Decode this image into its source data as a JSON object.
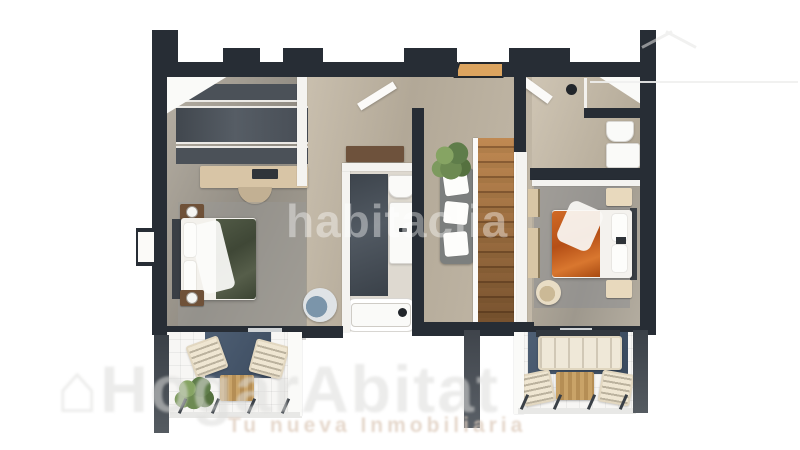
{
  "meta": {
    "description": "3D rendered top-down floor plan of an apartment upper floor: two bedrooms, two bathrooms, wooden staircase, hallway and two furnished terraces"
  },
  "watermarks": {
    "center": "habitaclia",
    "brand_house_icon": "⌂",
    "brand": "HogarAbitat",
    "tagline": "Tu nueva Inmobiliaria"
  },
  "colors": {
    "wall-dark": "#272d35",
    "floor-beige": "#c6bcab",
    "floor-gray": "#a9a49b",
    "white-surface": "#f4f3f0",
    "wood-stairs": "#a87544",
    "wood-light": "#dca45f",
    "closet-dark": "#4b5158",
    "bed-green": "#49513f",
    "bed-orange": "#c35a1c",
    "rug-blue": "#49596d",
    "rug-gray": "#9b9c9e",
    "plant-green": "#68854f",
    "wood-table": "#c9a368"
  }
}
